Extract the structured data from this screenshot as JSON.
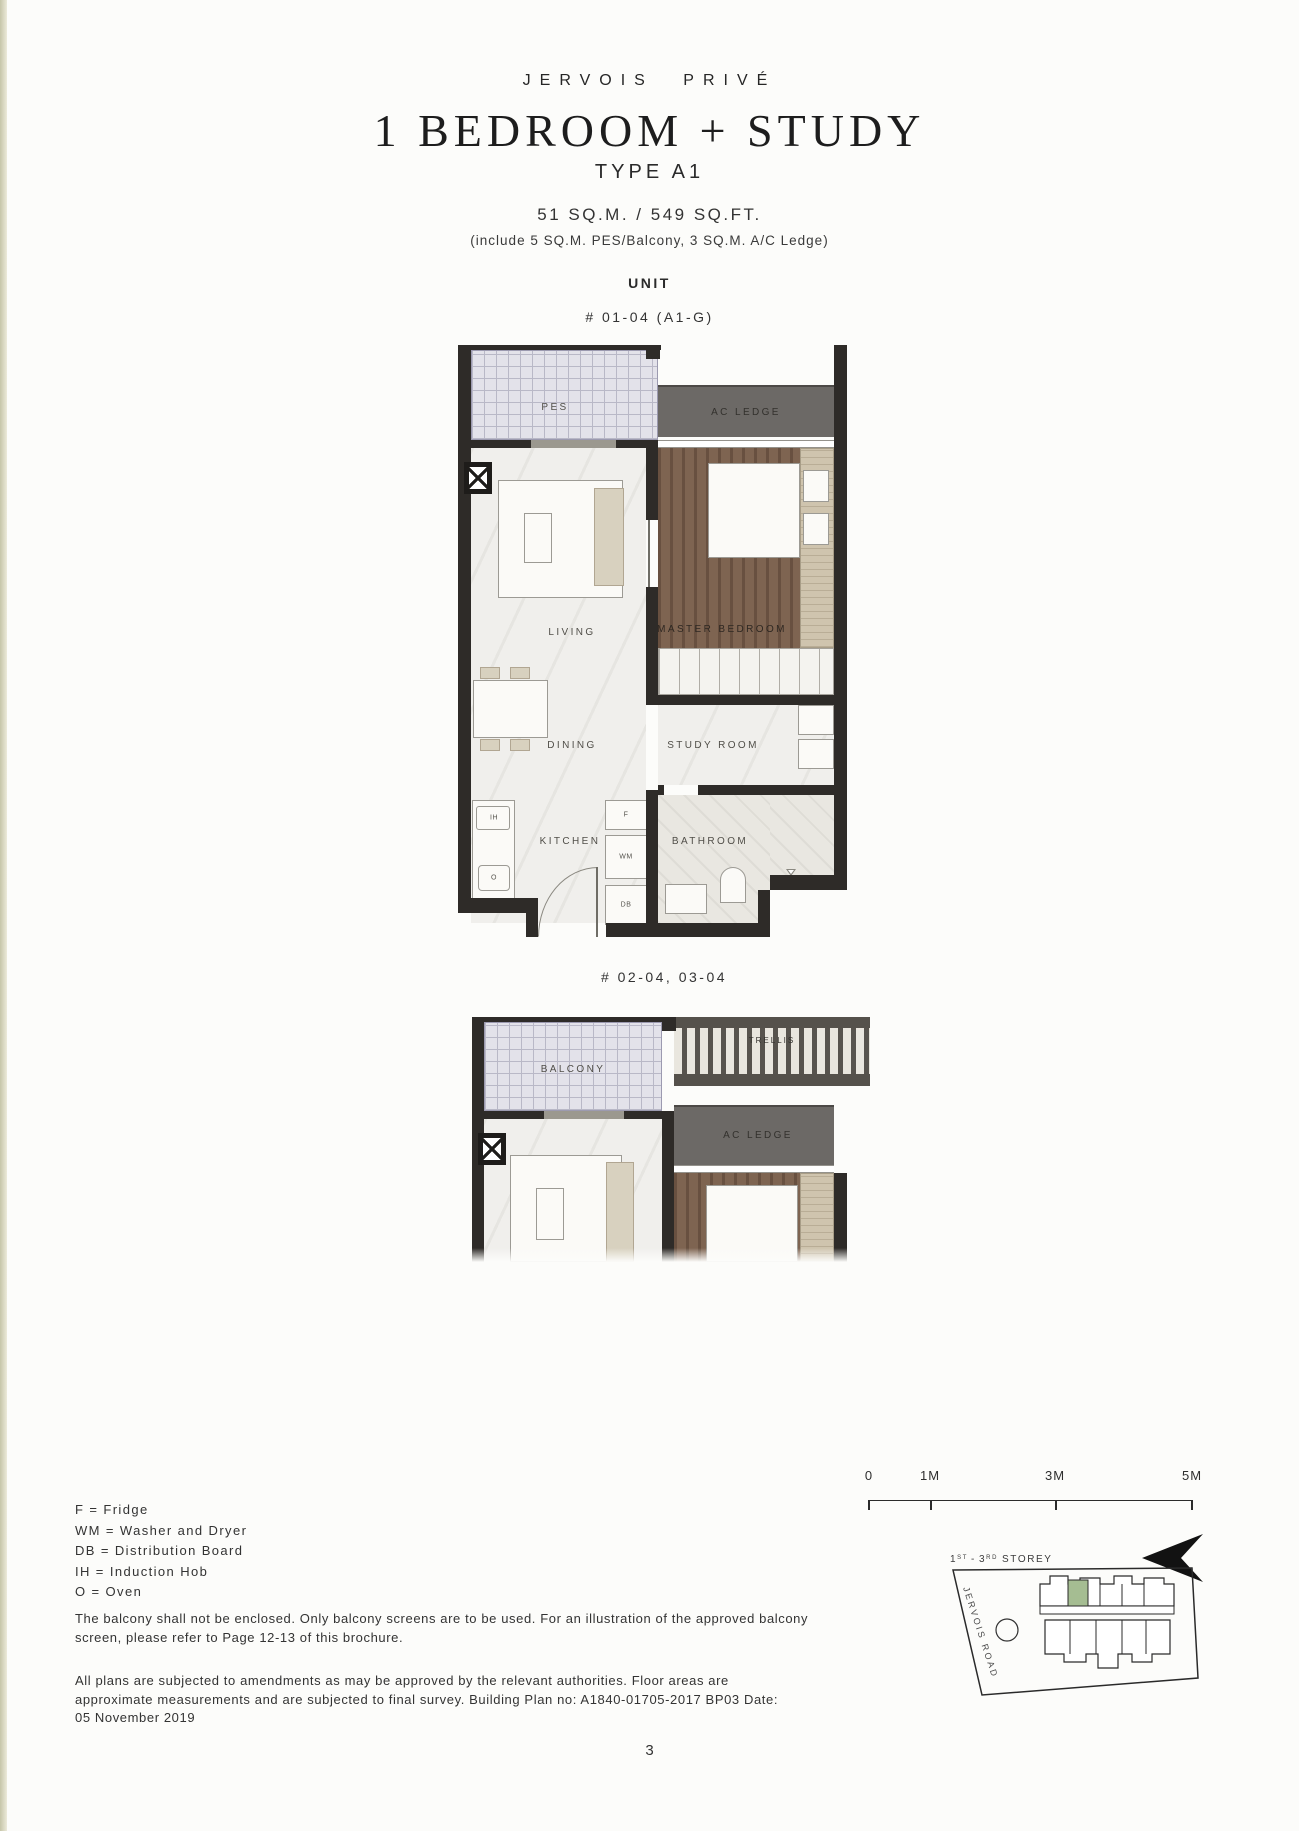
{
  "header": {
    "brand": "JERVOIS PRIVÉ",
    "title": "1 BEDROOM + STUDY",
    "unit_type": "TYPE A1",
    "area": "51 SQ.M. / 549 SQ.FT.",
    "area_note": "(include 5 SQ.M. PES/Balcony, 3 SQ.M. A/C Ledge)",
    "section_label": "UNIT"
  },
  "plan1": {
    "unit_label": "# 01-04 (A1-G)",
    "rooms": {
      "pes": "PES",
      "ac_ledge": "AC LEDGE",
      "living": "LIVING",
      "master_bedroom": "MASTER BEDROOM",
      "dining": "DINING",
      "study_room": "STUDY ROOM",
      "kitchen": "KITCHEN",
      "bathroom": "BATHROOM"
    },
    "appliances": {
      "fridge": "F",
      "washer_dryer": "WM",
      "distribution_board": "DB",
      "induction_hob": "IH",
      "oven": "O"
    }
  },
  "plan2": {
    "unit_label": "# 02-04, 03-04",
    "rooms": {
      "balcony": "BALCONY",
      "trellis": "TRELLIS",
      "ac_ledge": "AC LEDGE"
    }
  },
  "legend": [
    "F = Fridge",
    "WM = Washer and Dryer",
    "DB = Distribution Board",
    "IH = Induction Hob",
    "O = Oven"
  ],
  "notes": [
    "The balcony shall not be enclosed. Only balcony screens are to be used. For an illustration of the approved balcony screen, please refer to Page 12-13 of this brochure.",
    "All plans are subjected to amendments as may be approved by the relevant authorities. Floor areas are approximate measurements and are subjected to final survey. Building Plan no: A1840-01705-2017 BP03 Date: 05 November 2019"
  ],
  "scale_bar": {
    "labels": [
      "0",
      "1M",
      "3M",
      "5M"
    ]
  },
  "site_plan": {
    "storey": {
      "n1": "1",
      "s1": "ST",
      "sep": "-",
      "n2": "3",
      "s2": "RD",
      "rest": "STOREY"
    },
    "road_label": "JERVOIS ROAD"
  },
  "page_number": "3",
  "colors": {
    "wall": "#2e2b28",
    "wood_floor": "#7e6451",
    "ac_ledge": "#6c6966",
    "pes_tile": "#e3e2ea",
    "marble": "#f0efec",
    "site_highlight": "#a5bd92"
  }
}
